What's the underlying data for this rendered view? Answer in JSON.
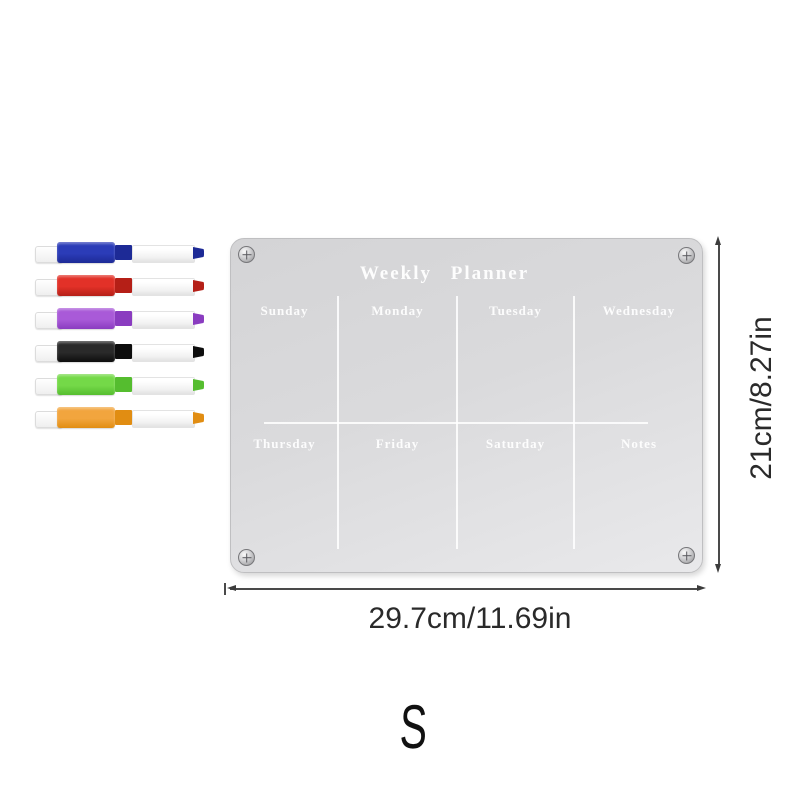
{
  "product": {
    "title": "Weekly Planner",
    "days_top": [
      "Sunday",
      "Monday",
      "Tuesday",
      "Wednesday"
    ],
    "days_bottom": [
      "Thursday",
      "Friday",
      "Saturday",
      "Notes"
    ]
  },
  "dimensions": {
    "height_label": "21cm/8.27in",
    "width_label": "29.7cm/11.69in"
  },
  "size_label": "S",
  "markers": [
    {
      "name": "blue-marker",
      "cap_color": "#2b3cb8",
      "dark_color": "#1d2a96"
    },
    {
      "name": "red-marker",
      "cap_color": "#e23128",
      "dark_color": "#b51f17"
    },
    {
      "name": "purple-marker",
      "cap_color": "#a95ad8",
      "dark_color": "#8a3cc0"
    },
    {
      "name": "black-marker",
      "cap_color": "#2a2a2a",
      "dark_color": "#0d0d0d"
    },
    {
      "name": "green-marker",
      "cap_color": "#74d948",
      "dark_color": "#55bd2f"
    },
    {
      "name": "orange-marker",
      "cap_color": "#f2a53e",
      "dark_color": "#e18d12"
    }
  ],
  "colors": {
    "board_light": "#e9e9eb",
    "board_dark": "#d4d4d6",
    "grid_line": "#ffffff",
    "dim_line": "#3c3c3c"
  }
}
